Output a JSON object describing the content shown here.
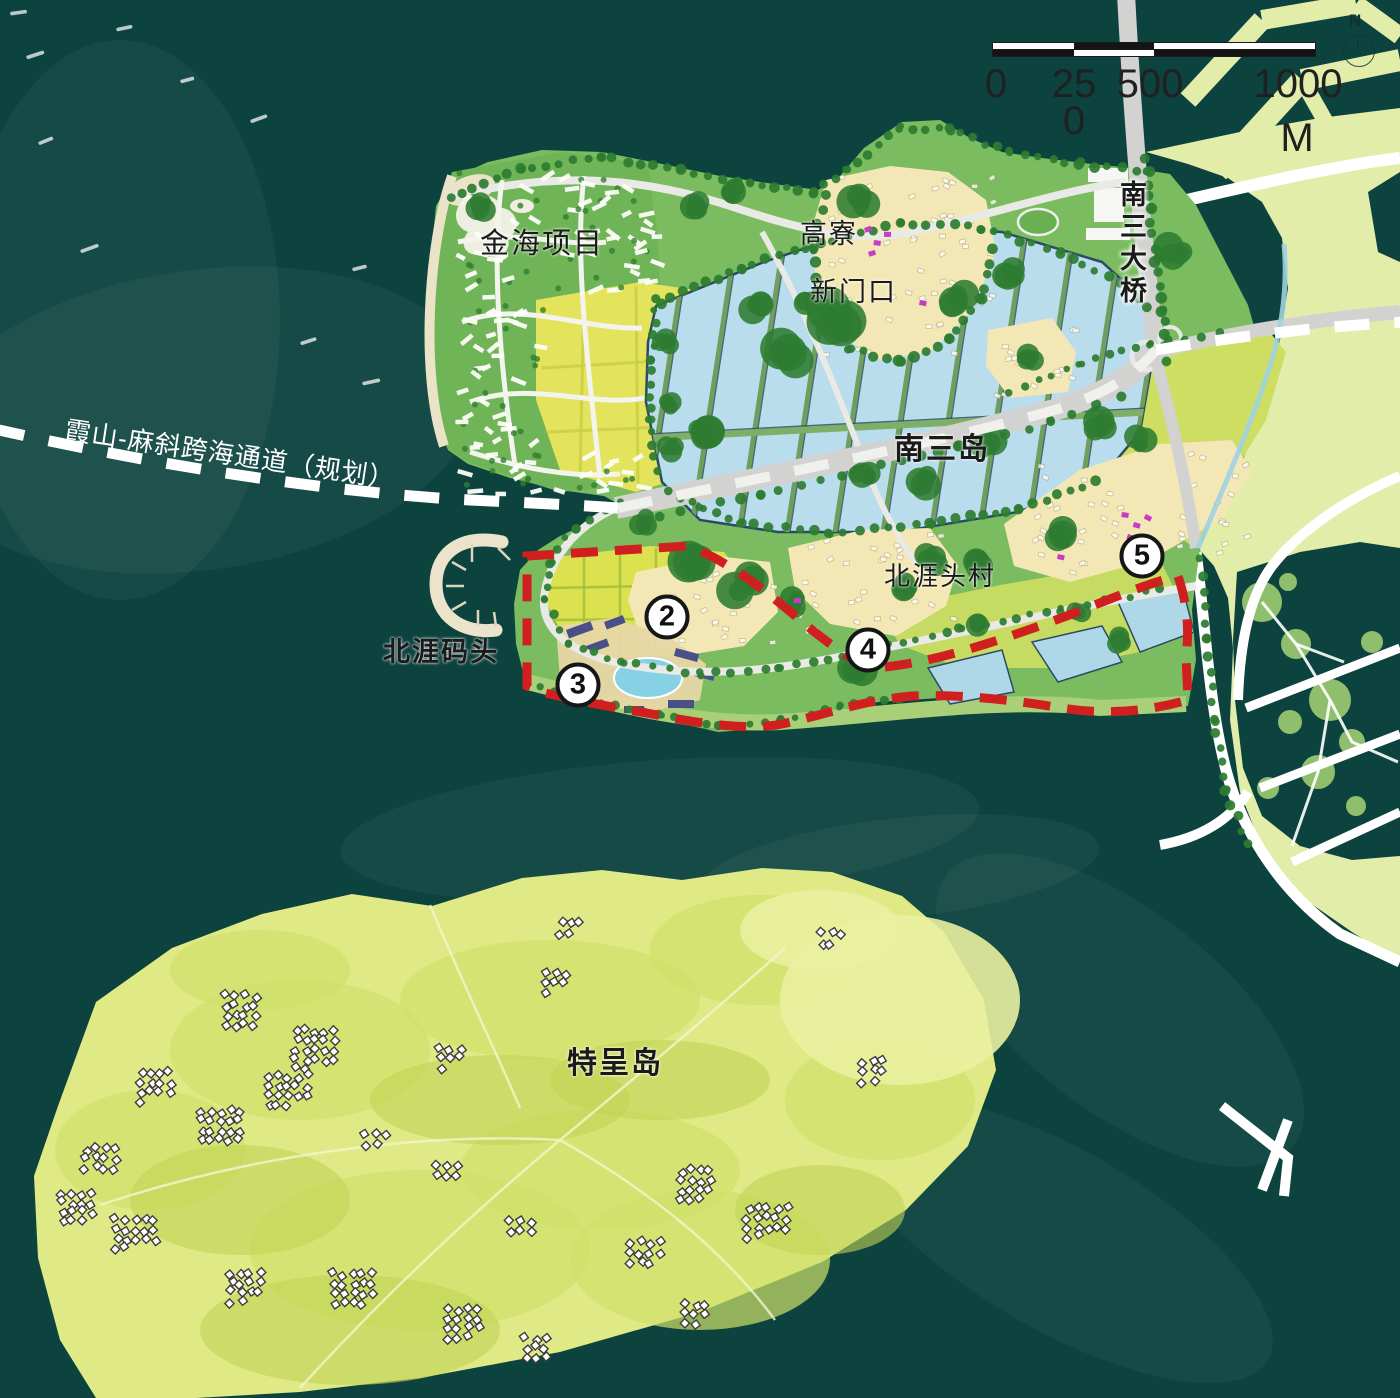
{
  "map": {
    "region_labels": {
      "jinhai": "金海项目",
      "gaoliao": "高寮",
      "xinmenkou": "新门口",
      "nansandao": "南三岛",
      "beiyatou_village": "北涯头村",
      "beiya_wharf": "北涯码头",
      "techeng_island": "特呈岛",
      "nansan_bridge": "南三大桥",
      "corridor": "霞山-麻斜跨海通道（规划）"
    },
    "markers": [
      {
        "id": "2",
        "label": "2"
      },
      {
        "id": "3",
        "label": "3"
      },
      {
        "id": "4",
        "label": "4"
      },
      {
        "id": "5",
        "label": "5"
      }
    ],
    "scale_bar": {
      "ticks": [
        "0",
        "250",
        "500",
        "1000"
      ],
      "unit": "M"
    },
    "north_label": "N",
    "colors": {
      "sea": "#0d433f",
      "island_green": "#7abc5f",
      "jinhai_green": "#6fb457",
      "tree_green": "#2d7c31",
      "beach_sand": "#eae3c8",
      "pond_blue": "#b9ddec",
      "pond_edge": "#2c4a66",
      "pond_small": "#aed8e8",
      "village_yellow": "#f3e8b5",
      "farm_yellow": "#e4e45c",
      "farm_green": "#cede62",
      "farm_light": "#dce24f",
      "coast_grass": "#a9cf79",
      "east_land": "#e3edaa",
      "techeng_land": "#dfe985",
      "road_gray": "#d2d2d0",
      "boundary_red": "#d01f1f",
      "pool_blue": "#86d2e4",
      "resort_purple": "#4b4f88",
      "village_magenta": "#c73bc7",
      "label_black": "#1a1a1a"
    }
  }
}
